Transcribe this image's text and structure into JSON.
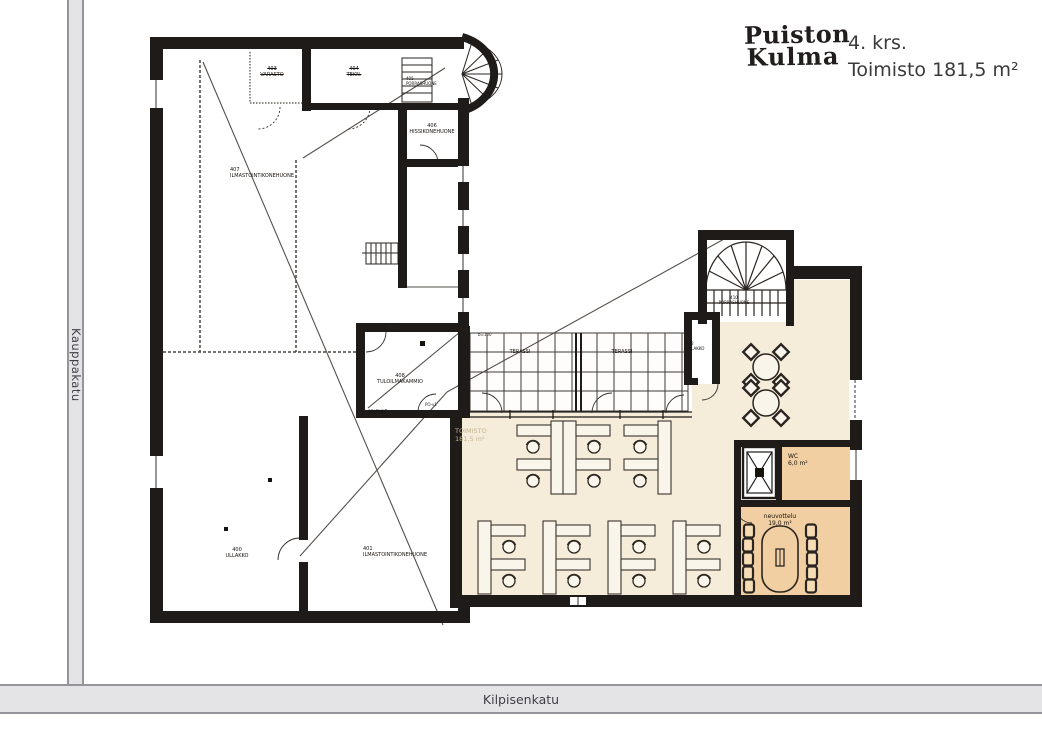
{
  "header": {
    "logo_line1": "Puiston",
    "logo_line2": "Kulma",
    "floor_label": "4. krs.",
    "area_label": "Toimisto 181,5 m²"
  },
  "streets": {
    "left": "Kauppakatu",
    "bottom": "Kilpisenkatu"
  },
  "plan": {
    "rooms": [
      {
        "num": "403",
        "name": "VARASTO"
      },
      {
        "num": "404",
        "name": "TEKN."
      },
      {
        "num": "405",
        "name": "PORRASHUONE"
      },
      {
        "num": "406",
        "name": "HISSIKONEHUONE"
      },
      {
        "num": "407",
        "name": "ILMASTOINTIKONEHUONE"
      },
      {
        "num": "408",
        "name": "TULOILMAKAMMIO"
      },
      {
        "num": "",
        "name": "SÄLEIKKÖ"
      },
      {
        "num": "400",
        "name": "ULLAKKO"
      },
      {
        "num": "401",
        "name": "ILMASTOINTIKONEHUONE"
      },
      {
        "num": "402",
        "name": "ULLAKKO"
      },
      {
        "num": "410",
        "name": "PORRASHUONE"
      },
      {
        "num": "",
        "name": "TERASSI"
      },
      {
        "num": "",
        "name": "TERASSI"
      },
      {
        "num": "TOIMISTO",
        "name": "181,5 m²"
      },
      {
        "num": "WC",
        "name": "6,0 m²"
      },
      {
        "num": "neuvottelu",
        "name": "19,0 m²"
      }
    ],
    "annotations": [
      "PO-v1",
      "PO-v1",
      "b=100"
    ]
  },
  "colors": {
    "office_fill": "#f5ecd9",
    "meeting_fill": "#f2cfa2",
    "wall": "#1f1b18",
    "street_band": "#e4e4e7"
  }
}
